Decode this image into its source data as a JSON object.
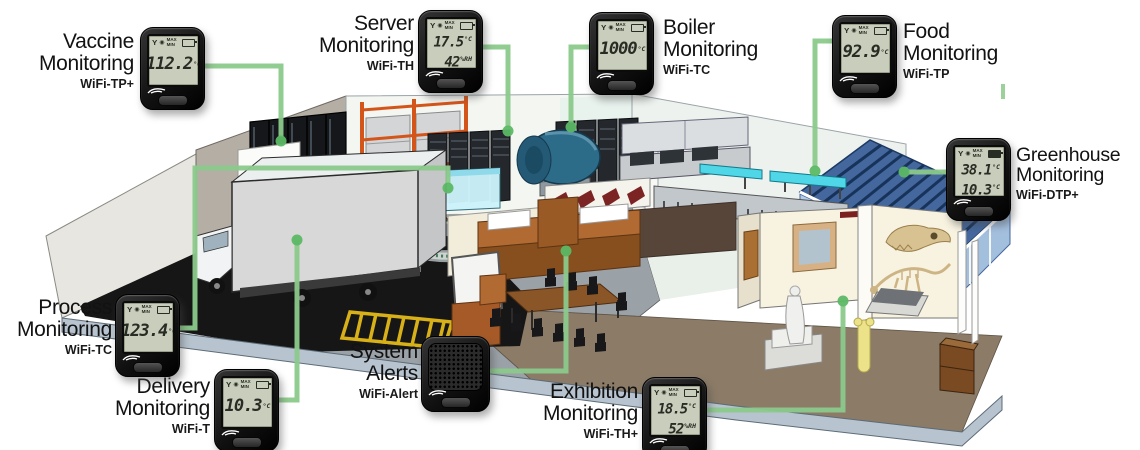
{
  "colors": {
    "connector_line": "#8bc98b",
    "connector_dot": "#5cb865",
    "device_body": "#1a1a1a",
    "lcd_background": "#c9cdbb",
    "lcd_text": "#272c24",
    "label_text": "#121212"
  },
  "lcd_icons": {
    "antenna": "Y",
    "alarm": "◉",
    "max_min": "MAX\nMIN"
  },
  "devices": [
    {
      "id": "vaccine",
      "title": "Vaccine\nMonitoring",
      "model": "WiFi-TP+",
      "kind": "lcd-sensor",
      "readings": [
        {
          "value": "112.2",
          "unit": "°C"
        }
      ]
    },
    {
      "id": "server",
      "title": "Server\nMonitoring",
      "model": "WiFi-TH",
      "kind": "lcd-sensor",
      "readings": [
        {
          "value": "17.5",
          "unit": "°C"
        },
        {
          "value": "42",
          "unit": "%RH"
        }
      ]
    },
    {
      "id": "boiler",
      "title": "Boiler\nMonitoring",
      "model": "WiFi-TC",
      "kind": "lcd-sensor",
      "readings": [
        {
          "value": "1000",
          "unit": "°C"
        }
      ]
    },
    {
      "id": "food",
      "title": "Food\nMonitoring",
      "model": "WiFi-TP",
      "kind": "lcd-sensor",
      "readings": [
        {
          "value": "92.9",
          "unit": "°C"
        }
      ]
    },
    {
      "id": "greenhouse",
      "title": "Greenhouse\nMonitoring",
      "model": "WiFi-DTP+",
      "kind": "lcd-sensor",
      "readings": [
        {
          "value": "38.1",
          "unit": "°C"
        },
        {
          "value": "10.3",
          "unit": "°C"
        }
      ]
    },
    {
      "id": "process",
      "title": "Process\nMonitoring",
      "model": "WiFi-TC",
      "kind": "lcd-sensor",
      "readings": [
        {
          "value": "123.4",
          "unit": "°C"
        }
      ]
    },
    {
      "id": "delivery",
      "title": "Delivery\nMonitoring",
      "model": "WiFi-T",
      "kind": "lcd-sensor",
      "readings": [
        {
          "value": "10.3",
          "unit": "°C"
        }
      ]
    },
    {
      "id": "alerts",
      "title": "System\nAlerts",
      "model": "WiFi-Alert",
      "kind": "alarm-speaker",
      "readings": []
    },
    {
      "id": "exhibition",
      "title": "Exhibition\nMonitoring",
      "model": "WiFi-TH+",
      "kind": "lcd-sensor",
      "readings": [
        {
          "value": "18.5",
          "unit": "°C"
        },
        {
          "value": "52",
          "unit": "%RH"
        }
      ]
    }
  ]
}
